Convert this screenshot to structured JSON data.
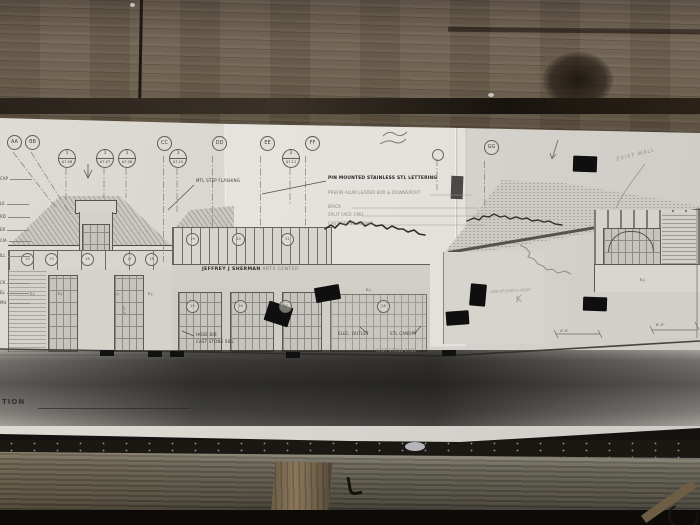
{
  "sheet": {
    "building_sign": {
      "primary": "JEFFREY J SHERMAN",
      "secondary": " ARTS CENTER"
    },
    "title_partial": "TION",
    "grid_bubbles": [
      "AA",
      "BB",
      "CC",
      "DD",
      "EE",
      "FF",
      "GG"
    ],
    "detail_refs": [
      {
        "num": "1",
        "sheet": "A7.08"
      },
      {
        "num": "1",
        "sheet": "A7.07"
      },
      {
        "num": "1",
        "sheet": "A7.08"
      },
      {
        "num": "1",
        "sheet": "A7.15"
      },
      {
        "num": "2",
        "sheet": "A7.11"
      }
    ],
    "annotations": {
      "mtl_flashing": "MTL STEP FLASHING",
      "pin_lettering": "PIN MOUNTED STAINLESS STL LETTERING",
      "leader_box": "PREFIN ALUM LEADER BOX & DOWNSPOUT",
      "brick": "BRICK",
      "split_face": "SPLIT FACE CMU",
      "coping": "CAST STONE COPING",
      "hose_bib": "HOSE BIB",
      "stone_sill": "CAST STONE SILL",
      "elec_outlet": "ELEC. OUTLET",
      "stl_canopy": "STL CANOPY",
      "stone_base": "CAST STONE BASE"
    },
    "pencil_notes": {
      "exist_wall": "EXIST WALL",
      "exist_roof": "LINE OF EXIST'G ROOF",
      "k_mark": "K"
    },
    "edge_fragments": [
      "CAP",
      "LE",
      "RD",
      "ER",
      "CIA",
      "ILL",
      "CK",
      "EL",
      "MU"
    ],
    "ej_label": "E.J.",
    "window_tags": [
      "14",
      "15",
      "16",
      "17",
      "18",
      "19",
      "20",
      "21",
      "25",
      "26",
      "27",
      "28"
    ],
    "dimensions": [
      "4'-0\"",
      "6'-0\"",
      "2'-0\""
    ],
    "colors": {
      "tape": "#0f0f0f",
      "paper": "#d8d5cf",
      "wood": "#6b5e4c",
      "pencil": "#97917f"
    }
  }
}
